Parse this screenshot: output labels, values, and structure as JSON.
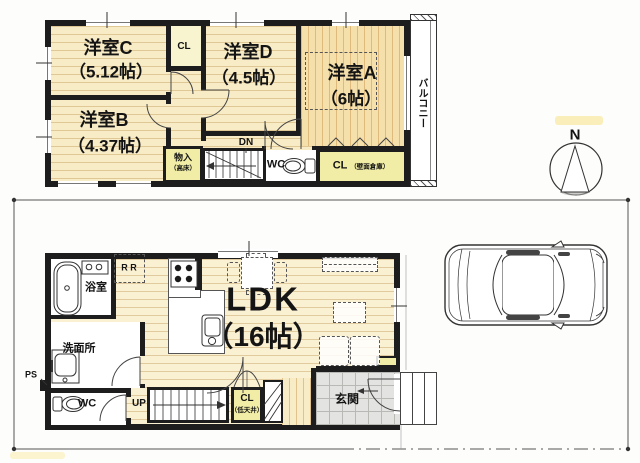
{
  "floor2": {
    "rooms": {
      "c": {
        "name": "洋室C",
        "area": "（5.12帖）"
      },
      "d": {
        "name": "洋室D",
        "area": "（4.5帖）"
      },
      "a": {
        "name": "洋室A",
        "area": "（6帖）"
      },
      "b": {
        "name": "洋室B",
        "area": "（4.37帖）"
      }
    },
    "closet_c_label": "CL",
    "storage_label": "物入",
    "storage_note": "（高床）",
    "stairs_label": "DN",
    "toilet_label": "WC",
    "closet_a_label": "CL",
    "closet_a_note": "（壁面倉庫）",
    "balcony_label": "バルコニー"
  },
  "floor1": {
    "bathroom_label": "浴室",
    "fridge_label": "R R",
    "washroom_label": "洗面所",
    "pipe_space_label": "PS",
    "toilet_label": "WC",
    "stairs_label": "UP",
    "closet_label": "CL",
    "closet_note": "（低天井）",
    "entrance_label": "玄関",
    "ldk": {
      "name": "LDK",
      "area": "（16帖）"
    }
  },
  "compass": {
    "north_label": "N"
  },
  "colors": {
    "wall": "#1d1d1d",
    "floor_wood": "#f8ecc6",
    "floor_wood_dark": "#f5e0ac",
    "closet_yellow": "#f1eda6",
    "tile_gray": "#e3e3e1",
    "line": "#444444"
  }
}
